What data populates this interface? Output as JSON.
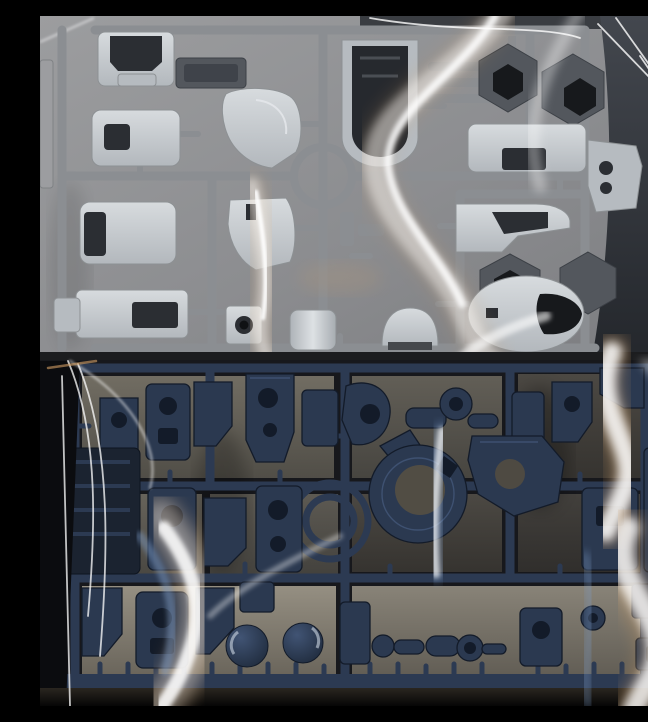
{
  "scene": {
    "description": "Photograph of two injection-molded model kit part runners (sprues), each sealed in a glossy clear plastic bag, shot from above",
    "top_runner": {
      "description": "Light gray armor-part sprue in clear bag on gray backdrop with white photo border at right",
      "plastic_color_name": "light gray",
      "runner_frame_color_name": "medium gray",
      "parts": [
        "chest-armor",
        "side-vent-plate",
        "leg-armor",
        "curved-shoulder-armor",
        "front-skirt-armor",
        "waist-box",
        "side-tab",
        "camera-housing",
        "thruster-cylinder",
        "head-dome",
        "u-shaped-frame",
        "thin-rod-parts",
        "dark-hex-joint-cover",
        "dark-hex-joint-cover-2",
        "backpack-box",
        "small-bracket",
        "forked-shin-armor",
        "dark-hex-frame",
        "dark-hex-frame-2",
        "egg-shaped-body-shell"
      ],
      "center_feature": "circular-runner-ring"
    },
    "bottom_runner": {
      "description": "Dark navy inner-frame sprue in clear bag on dark backdrop with strong white and gold bag reflections",
      "plastic_color_name": "dark navy blue",
      "parts": [
        "joint-brackets",
        "frame-blocks",
        "round-joint",
        "arm-chain",
        "gear-ring-torso-frame",
        "gear-plate",
        "side-panels",
        "knuckle-pieces",
        "shoulder-dome",
        "shoulder-dome-2",
        "ball-joint-chain",
        "polycap-ring",
        "polycap-ring-2",
        "edge-panels"
      ],
      "center_feature": "double-runner-ring"
    },
    "bag": {
      "description": "Glossy transparent bags producing white, gold and blue specular streak reflections"
    }
  },
  "palette": {
    "top-bg": "#96979a",
    "top-bg-dark": "#7e7f82",
    "top-dark": "#383c43",
    "rail-gray": "#8b8e92",
    "part-light": "#d2d6da",
    "part-mid": "#b6bbc0",
    "part-dark": "#53575d",
    "opening-dark": "#2b2e33",
    "white-strip": "#efeeec",
    "navy": "#2b3950",
    "navy-rail": "#2c3a52",
    "navy-light": "#46597c",
    "navy-dark": "#131b29",
    "table": "#716c60",
    "table-light": "#918b7e",
    "bot-bg": "#17181c",
    "bot-edge": "#0b0c0f",
    "refl-gold": "#d4a066",
    "refl-blue": "#7d9cc8",
    "refl-white": "#ffffff"
  }
}
